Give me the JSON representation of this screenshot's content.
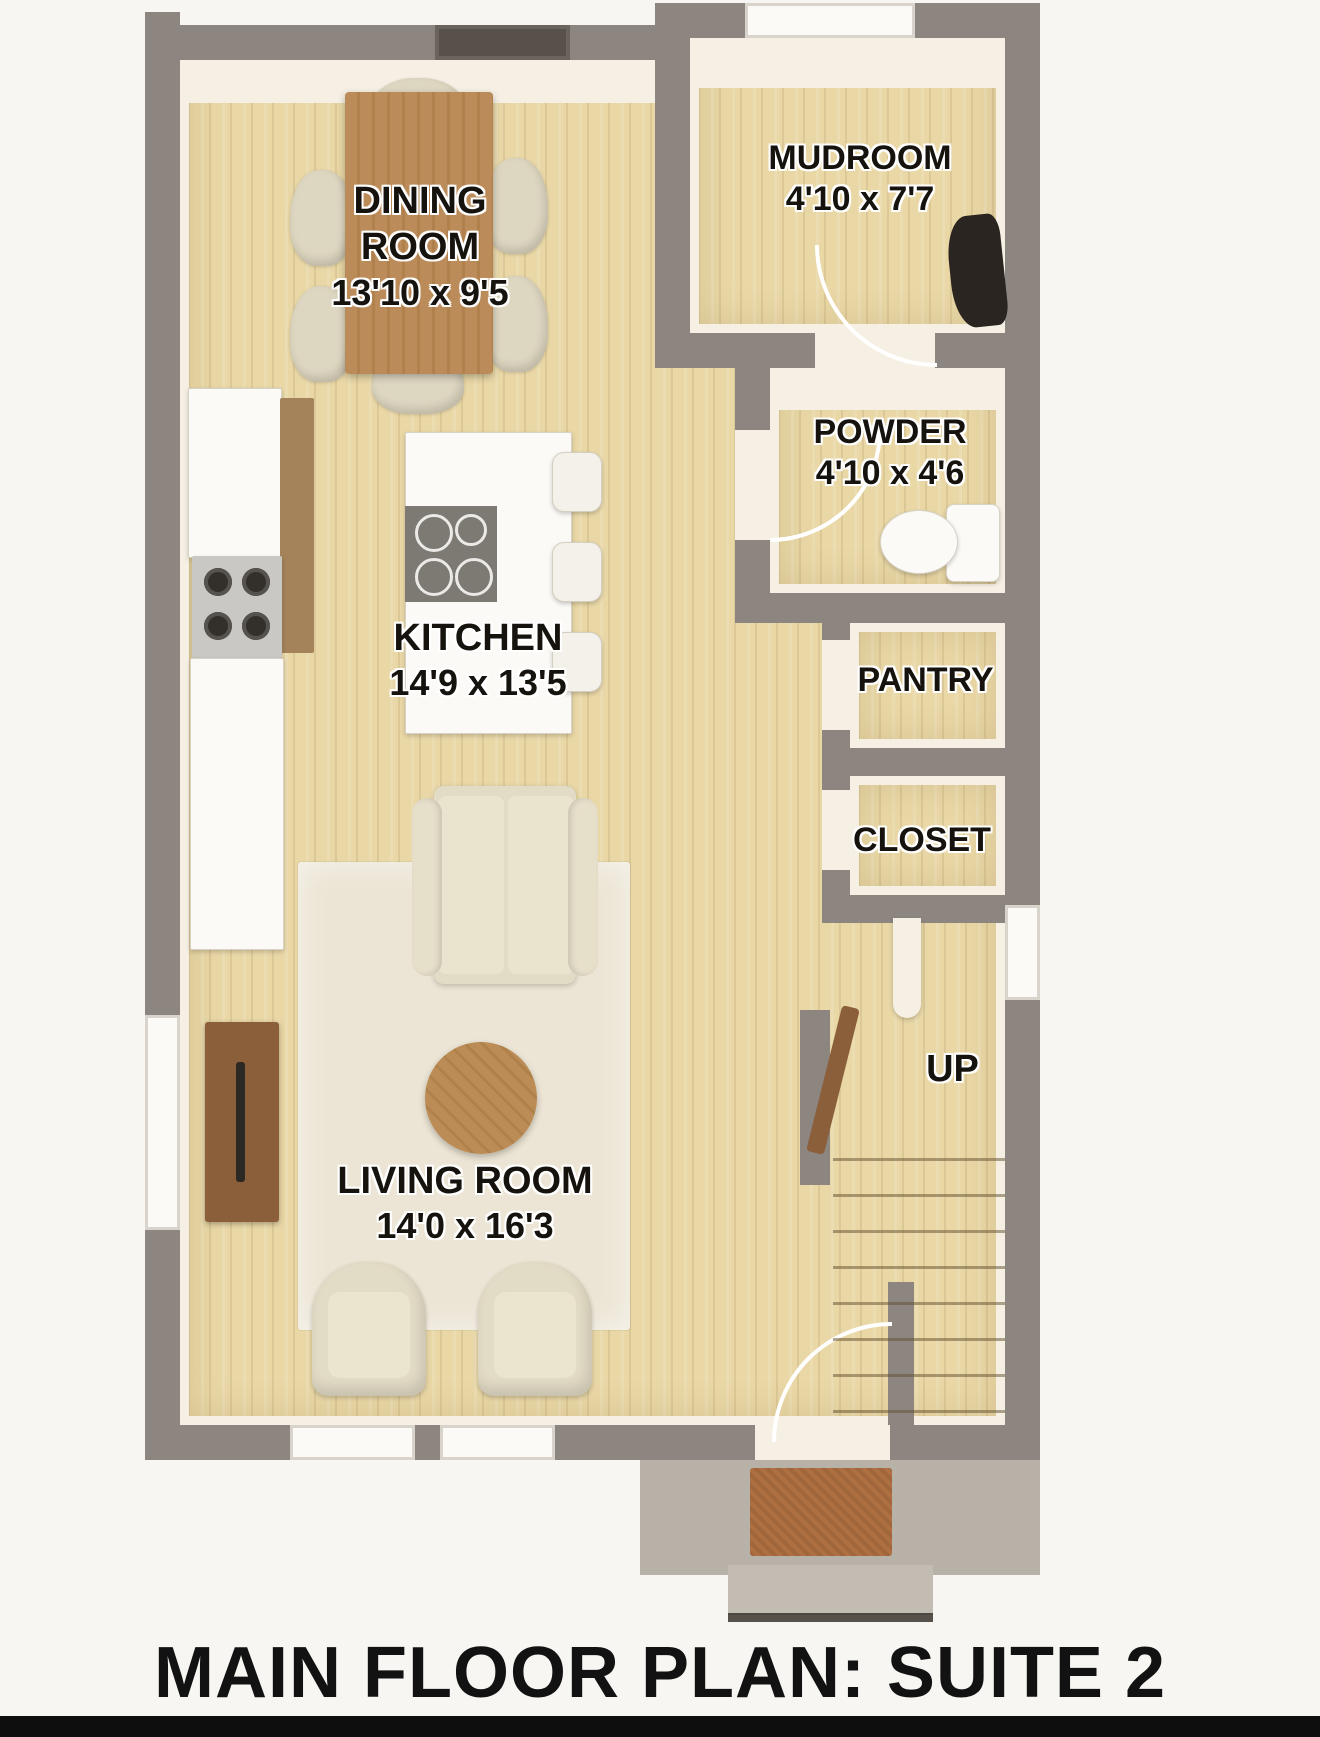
{
  "title": "MAIN FLOOR PLAN: SUITE 2",
  "rooms": {
    "dining": {
      "line1": "DINING",
      "line2": "ROOM",
      "dims": "13'10 x 9'5"
    },
    "mudroom": {
      "name": "MUDROOM",
      "dims": "4'10 x 7'7"
    },
    "powder": {
      "name": "POWDER",
      "dims": "4'10 x 4'6"
    },
    "kitchen": {
      "name": "KITCHEN",
      "dims": "14'9 x 13'5"
    },
    "pantry": {
      "name": "PANTRY"
    },
    "closet": {
      "name": "CLOSET"
    },
    "living": {
      "name": "LIVING ROOM",
      "dims": "14'0 x 16'3"
    },
    "stairs": {
      "label": "UP"
    }
  },
  "colors": {
    "wall": "#8d8680",
    "floor": "#e9d7a6",
    "trim": "#f6f0e4",
    "rug": "#ece5d5",
    "upholstery": "#e2dbc5",
    "wood_dark": "#b5854f",
    "wood_console": "#8a5f3a",
    "porch": "#b8b1a7",
    "mat": "#ae6f41",
    "label_ink": "#16120d",
    "title_ink": "#121212",
    "fixture_white": "#fbfaf7",
    "appliance_steel": "#c9c8c4",
    "burner_dark": "#33302c",
    "cooktop_gray": "#7d7973",
    "bench_dark": "#2a2520",
    "background": "#f7f6f2"
  }
}
